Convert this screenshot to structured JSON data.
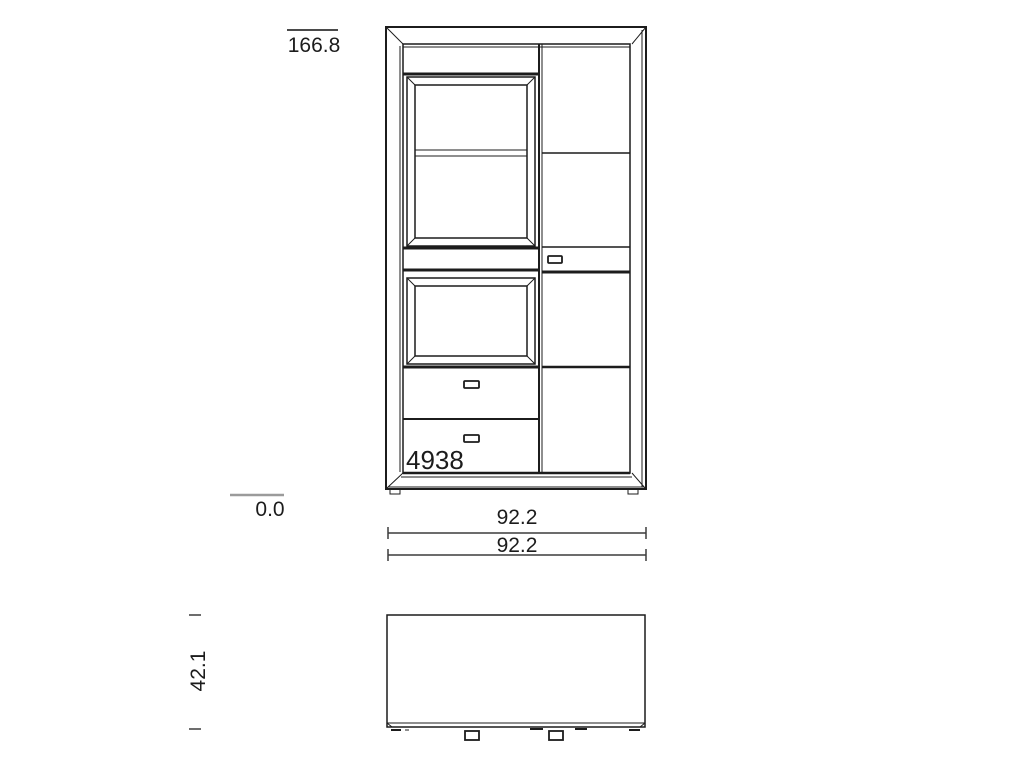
{
  "drawing": {
    "type": "furniture-technical-drawing",
    "colors": {
      "background": "#ffffff",
      "line": "#1c1c1c",
      "dimension_line": "#3c3c3c",
      "baseline_marker": "#9b9b9b"
    },
    "front_view": {
      "article_number": "4938",
      "dimensions": {
        "total_height": "166.8",
        "base_height": "0.0",
        "width_top": "92.2",
        "width_bottom": "92.2"
      }
    },
    "top_view": {
      "dimensions": {
        "depth": "42.1"
      }
    }
  }
}
